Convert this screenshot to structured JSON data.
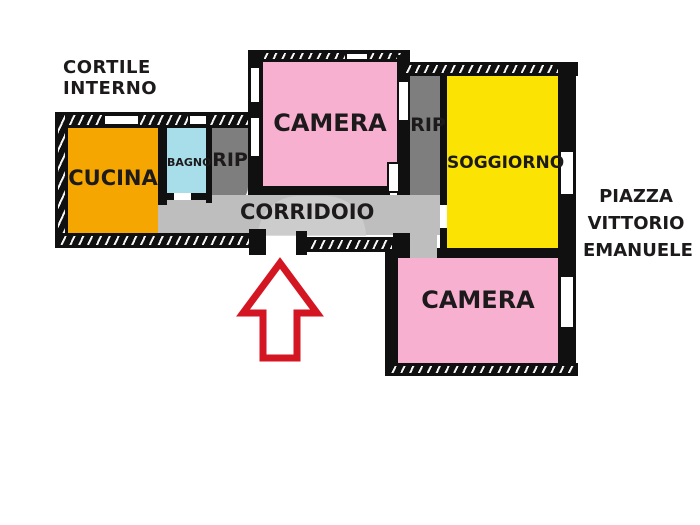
{
  "outside_labels": {
    "courtyard": "CORTILE INTERNO",
    "street_line1": "PIAZZA",
    "street_line2": "VITTORIO",
    "street_line3": "EMANUELE"
  },
  "rooms": {
    "cucina": {
      "label": "CUCINA",
      "color": "#F5A600"
    },
    "bagno": {
      "label": "BAGNO",
      "color": "#A8DDEA"
    },
    "rip1": {
      "label": "RIP",
      "color": "#7E7E7E"
    },
    "camera1": {
      "label": "CAMERA",
      "color": "#F8B0D1"
    },
    "rip2": {
      "label": "RIP",
      "color": "#7E7E7E"
    },
    "soggiorno": {
      "label": "SOGGIORNO",
      "color": "#FBE404"
    },
    "corridoio": {
      "label": "CORRIDOIO",
      "color": "#BEBEBE"
    },
    "camera2": {
      "label": "CAMERA",
      "color": "#F8B0D1"
    }
  },
  "entrance": {
    "arrow_color": "#D31622"
  }
}
